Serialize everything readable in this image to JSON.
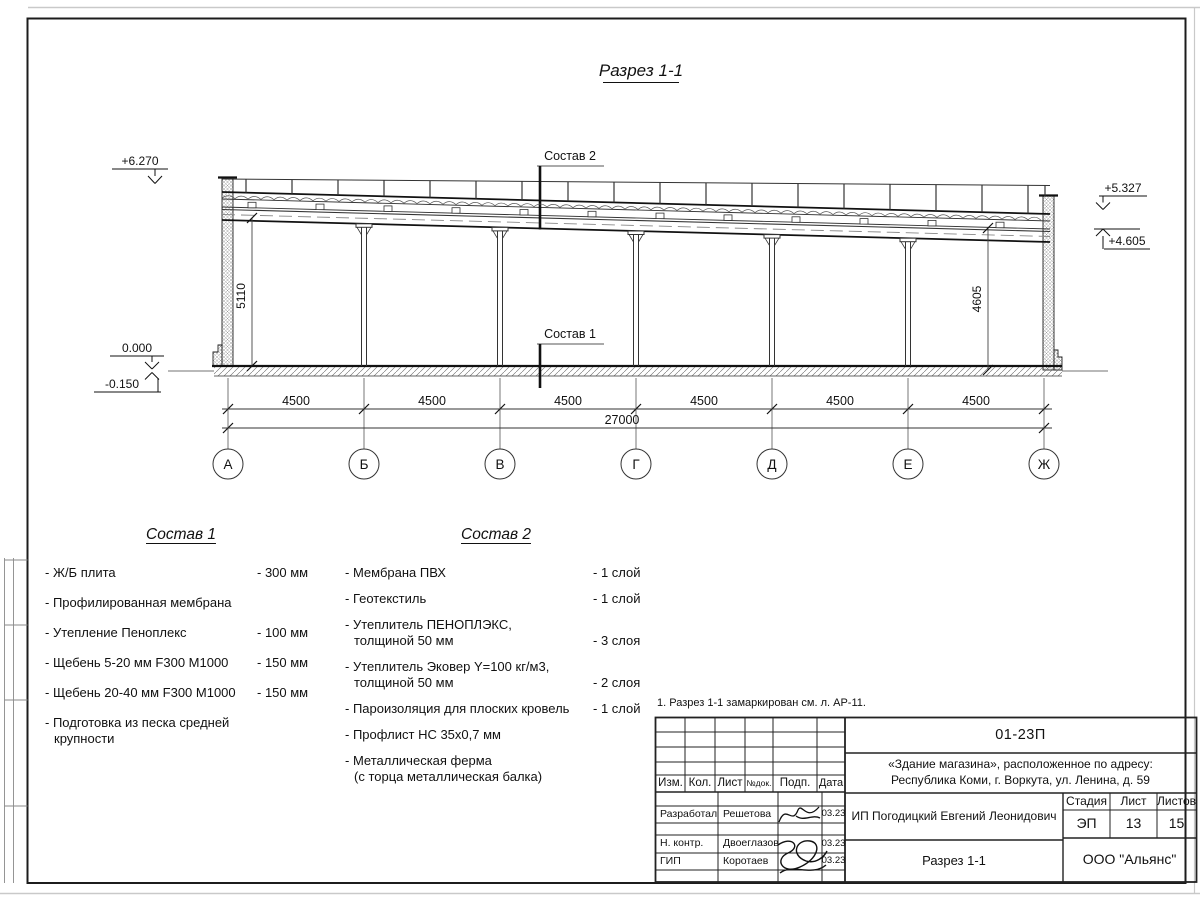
{
  "drawing": {
    "title": "Разрез 1-1",
    "callouts": {
      "c1": "Состав 1",
      "c2": "Состав 2"
    },
    "elevations": {
      "plus6270": "+6.270",
      "zero": "0.000",
      "minus0150": "-0.150",
      "plus5327": "+5.327",
      "plus4605": "+4.605"
    },
    "vert_dims": {
      "left": "5110",
      "right": "4605"
    },
    "bay_dims": [
      "4500",
      "4500",
      "4500",
      "4500",
      "4500",
      "4500"
    ],
    "total_dim": "27000",
    "axes": [
      "А",
      "Б",
      "В",
      "Г",
      "Д",
      "Е",
      "Ж"
    ]
  },
  "sostav1": {
    "title": "Состав 1",
    "items": [
      {
        "name": "- Ж/Б плита",
        "name2": "",
        "value": "- 300 мм"
      },
      {
        "name": "- Профилированная мембрана",
        "name2": "",
        "value": ""
      },
      {
        "name": "- Утепление Пеноплекс",
        "name2": "",
        "value": "- 100 мм"
      },
      {
        "name": "- Щебень 5-20 мм F300 М1000",
        "name2": "",
        "value": "- 150 мм"
      },
      {
        "name": "- Щебень 20-40 мм F300 М1000",
        "name2": "",
        "value": "- 150 мм"
      },
      {
        "name": "- Подготовка из песка средней",
        "name2": "крупности",
        "value": ""
      }
    ]
  },
  "sostav2": {
    "title": "Состав 2",
    "items": [
      {
        "name": "- Мембрана ПВХ",
        "name2": "",
        "value": "- 1 слой"
      },
      {
        "name": "- Геотекстиль",
        "name2": "",
        "value": "- 1 слой"
      },
      {
        "name": "- Утеплитель ПЕНОПЛЭКС,",
        "name2": "толщиной 50 мм",
        "value": "- 3 слоя"
      },
      {
        "name": "- Утеплитель Эковер Y=100 кг/м3,",
        "name2": "толщиной 50 мм",
        "value": "- 2 слоя"
      },
      {
        "name": "- Пароизоляция для плоских кровель",
        "name2": "",
        "value": "- 1 слой"
      },
      {
        "name": "- Профлист НС 35х0,7 мм",
        "name2": "",
        "value": ""
      },
      {
        "name": "- Металлическая ферма",
        "name2": "(с торца металлическая балка)",
        "value": ""
      }
    ]
  },
  "note": "1. Разрез 1-1 замаркирован см. л. АР-11.",
  "titleblock": {
    "doc_number": "01-23П",
    "project_line1": "«Здание магазина», расположенное по адресу:",
    "project_line2": "Республика Коми, г. Воркута, ул. Ленина, д. 59",
    "client": "ИП Погодицкий Евгений Леонидович",
    "sheet_title": "Разрез 1-1",
    "company": "ООО \"Альянс\"",
    "headers": {
      "izm": "Изм.",
      "kol": "Кол.",
      "list": "Лист",
      "ndok": "№док.",
      "podp": "Подп.",
      "data": "Дата"
    },
    "stage_label": "Стадия",
    "sheet_label": "Лист",
    "sheets_label": "Листов",
    "stage": "ЭП",
    "sheet": "13",
    "sheets": "15",
    "rows": [
      {
        "role": "Разработал",
        "name": "Решетова",
        "date": "03.23"
      },
      {
        "role": "Н. контр.",
        "name": "Двоеглазов",
        "date": "03.23"
      },
      {
        "role": "ГИП",
        "name": "Коротаев",
        "date": "03.23"
      }
    ]
  }
}
